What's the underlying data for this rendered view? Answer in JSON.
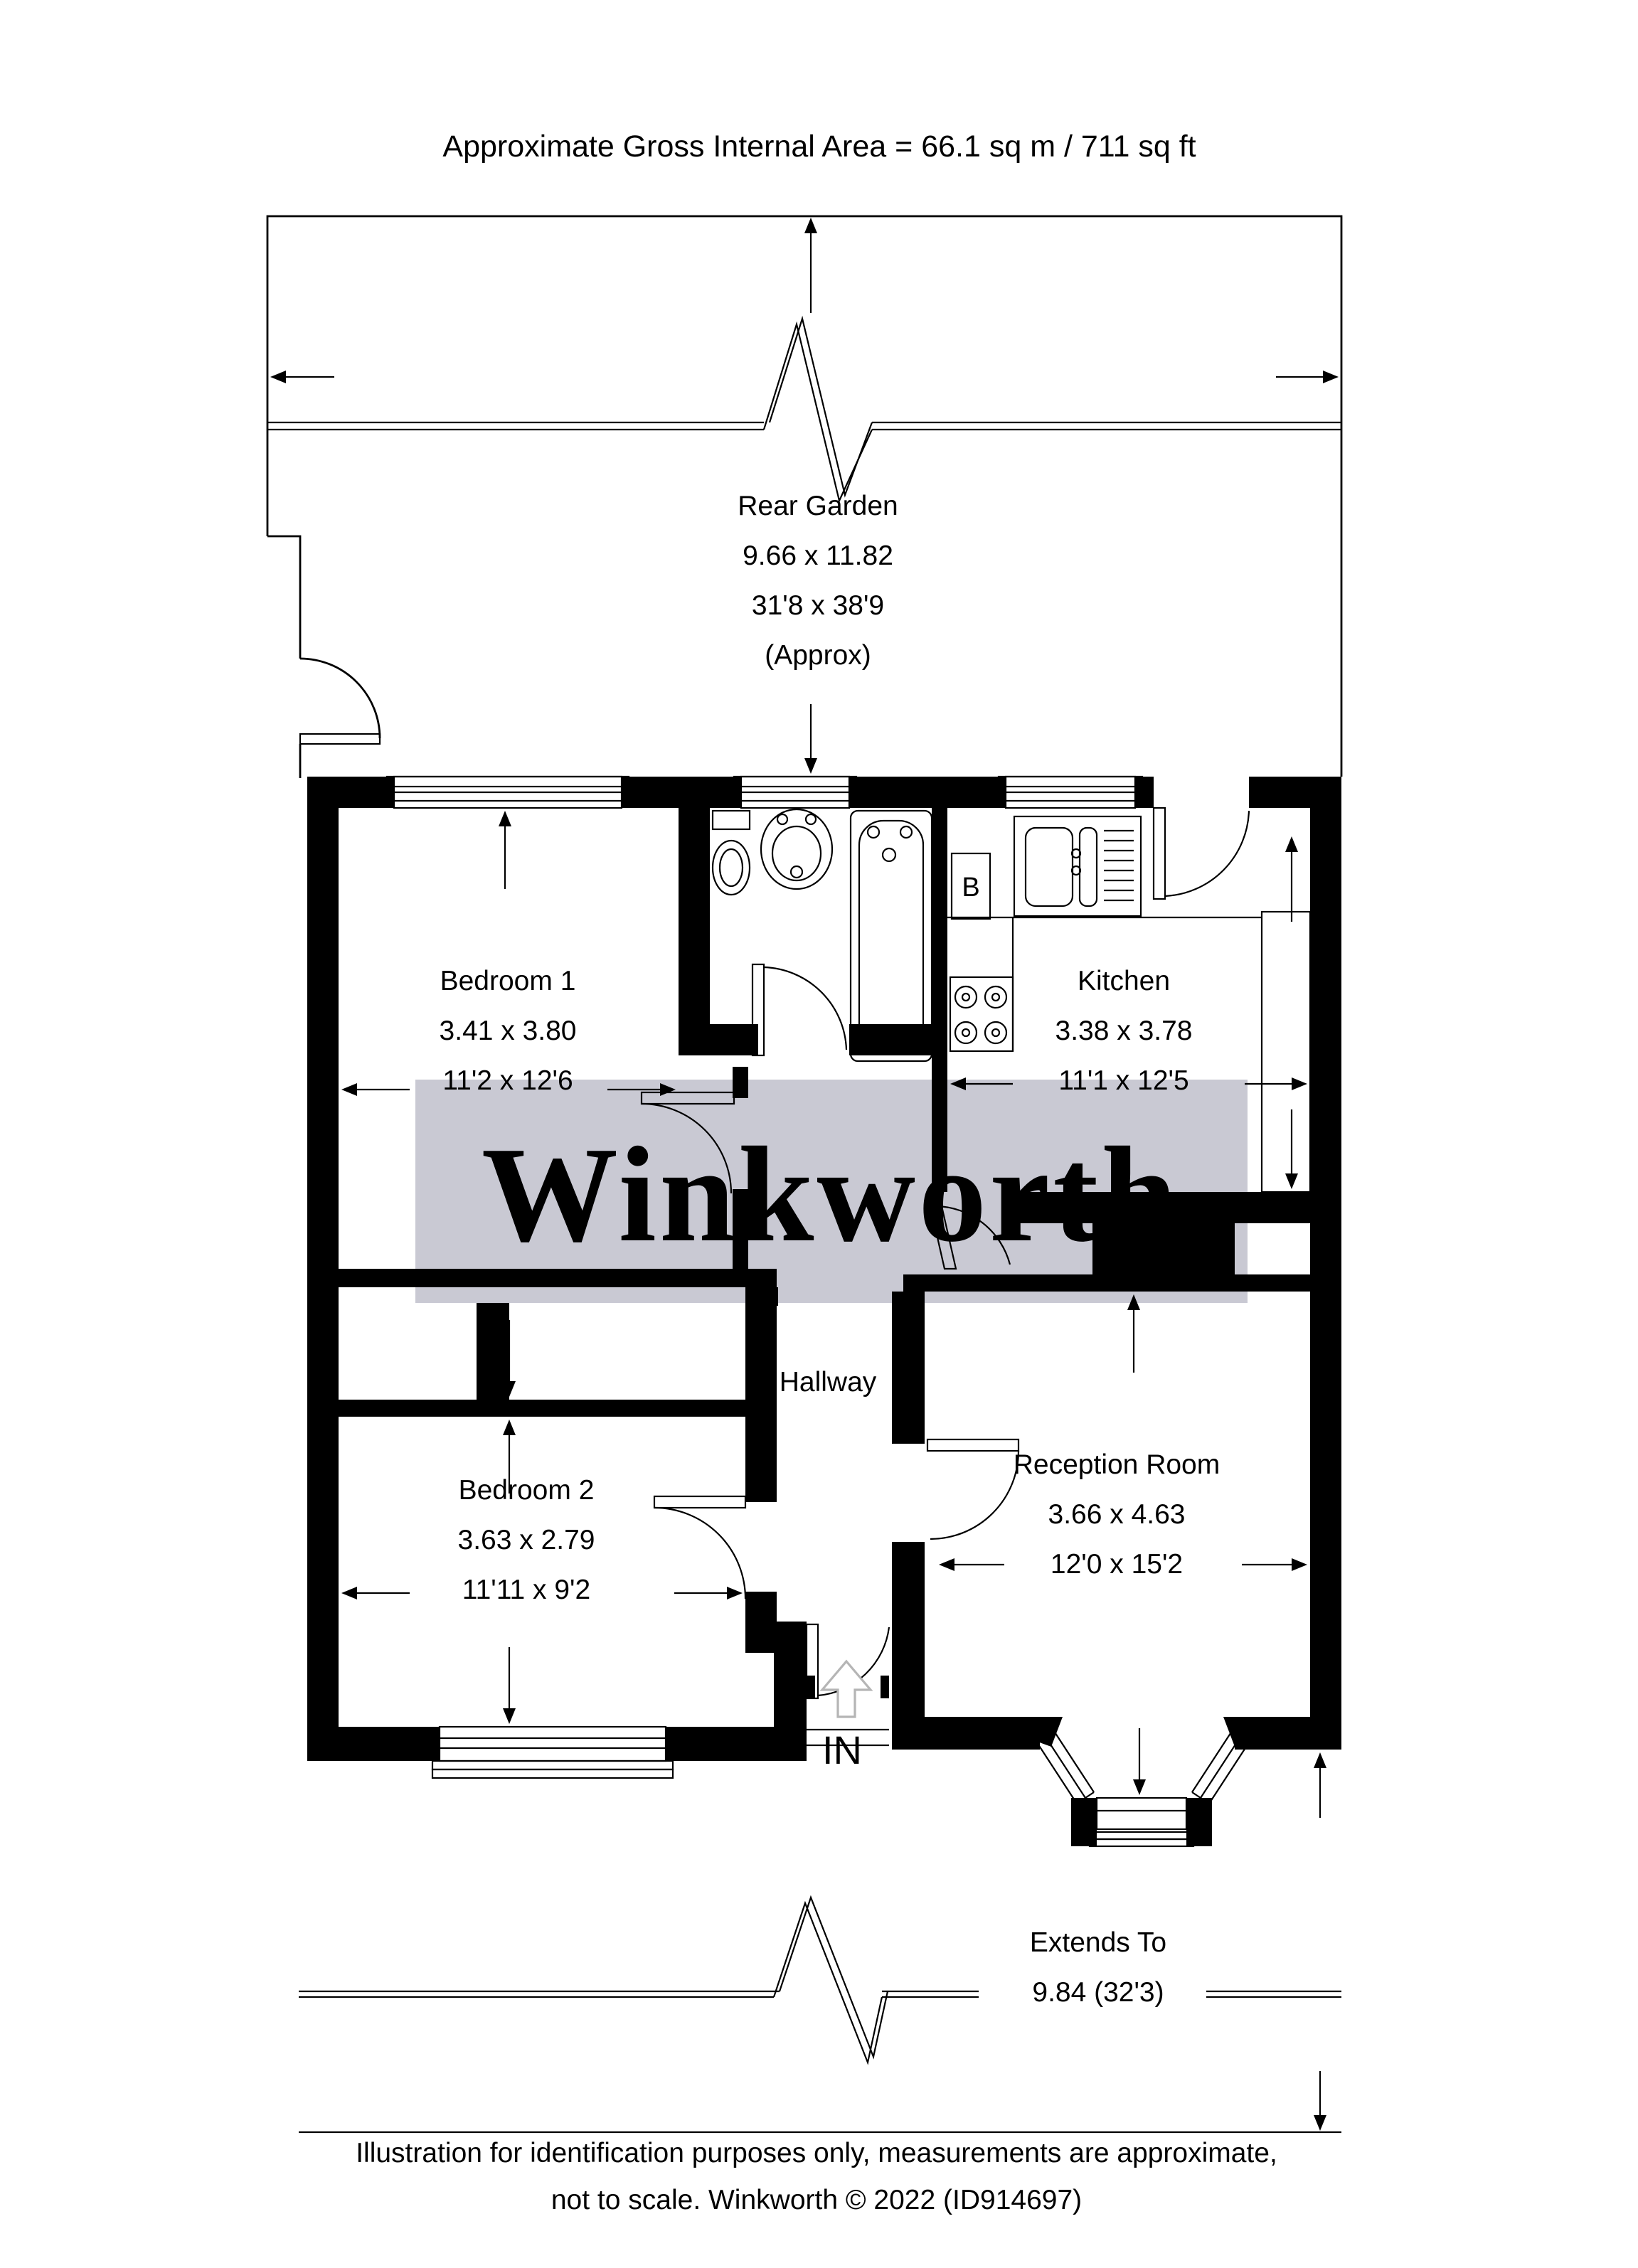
{
  "title": "Approximate Gross Internal Area = 66.1 sq m / 711 sq ft",
  "watermark": "Winkworth",
  "rooms": {
    "rear_garden": {
      "name": "Rear Garden",
      "metric": "9.66 x 11.82",
      "imperial": "31'8 x 38'9",
      "note": "(Approx)"
    },
    "bedroom1": {
      "name": "Bedroom 1",
      "metric": "3.41 x 3.80",
      "imperial": "11'2 x 12'6"
    },
    "kitchen": {
      "name": "Kitchen",
      "metric": "3.38 x 3.78",
      "imperial": "11'1 x 12'5"
    },
    "hallway": {
      "name": "Hallway"
    },
    "bedroom2": {
      "name": "Bedroom 2",
      "metric": "3.63 x 2.79",
      "imperial": "11'11 x 9'2"
    },
    "reception": {
      "name": "Reception Room",
      "metric": "3.66 x 4.63",
      "imperial": "12'0 x 15'2"
    }
  },
  "labels": {
    "entrance": "IN",
    "boiler": "B",
    "extends_line1": "Extends To",
    "extends_line2": "9.84 (32'3)"
  },
  "footer": {
    "line1": "Illustration for identification purposes only, measurements are approximate,",
    "line2": "not to scale. Winkworth © 2022 (ID914697)"
  },
  "colors": {
    "walls": "#000000",
    "watermark_bg": "#c9c9d3",
    "watermark_text": "#ffffff",
    "in_arrow": "#b5b5b5"
  }
}
